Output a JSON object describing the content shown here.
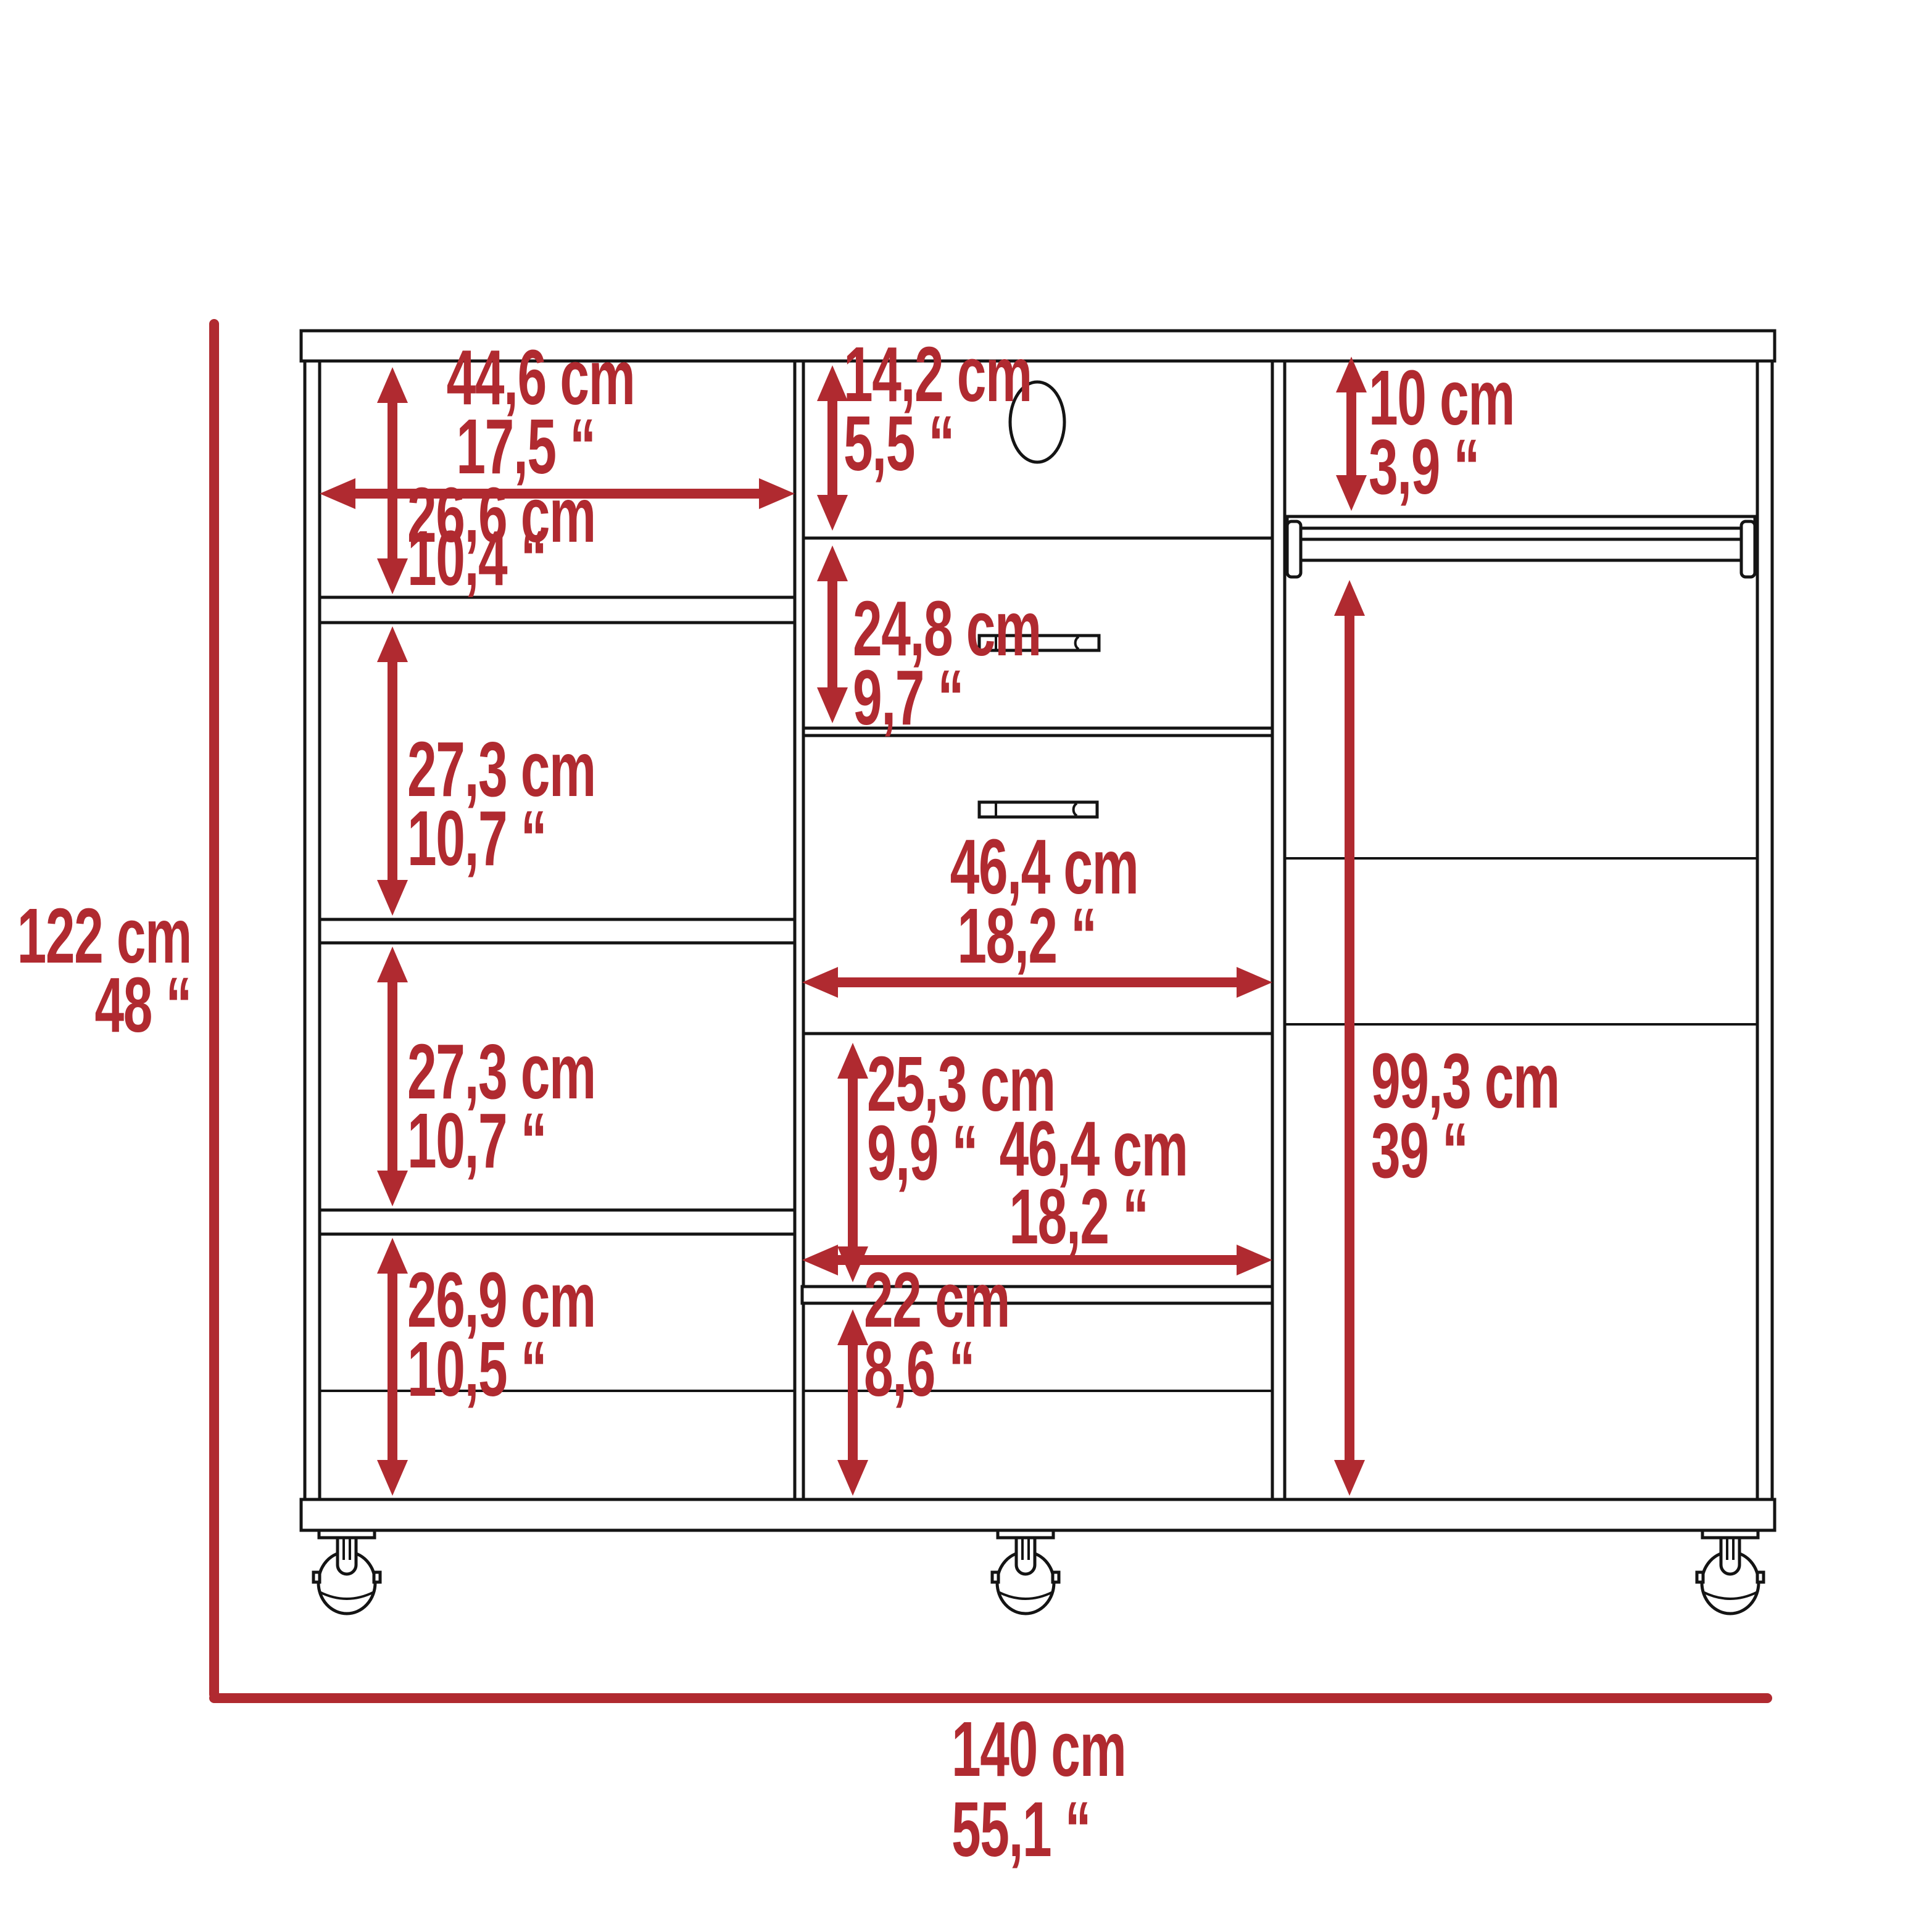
{
  "diagram": {
    "kind": "furniture-technical-drawing",
    "subject": "three-section dresser closet with drawers, shelves, hanging rod and casters",
    "colors": {
      "annotation": "#b02a30",
      "line": "#141414",
      "background": "#ffffff"
    }
  },
  "dimensions": {
    "overall_height": {
      "cm": "122 cm",
      "in": "48 “"
    },
    "overall_width": {
      "cm": "140 cm",
      "in": "55,1 “"
    },
    "left_column_width": {
      "cm": "44,6 cm",
      "in": "17,5 “"
    },
    "left_compartment_1": {
      "cm": "26,6 cm",
      "in": "10,4 “"
    },
    "left_compartment_2": {
      "cm": "27,3 cm",
      "in": "10,7 “"
    },
    "left_compartment_3": {
      "cm": "27,3 cm",
      "in": "10,7 “"
    },
    "left_compartment_4": {
      "cm": "26,9 cm",
      "in": "10,5 “"
    },
    "middle_top_opening": {
      "cm": "14,2 cm",
      "in": "5,5 “"
    },
    "drawer_front_height": {
      "cm": "24,8 cm",
      "in": "9,7 “"
    },
    "drawer_width": {
      "cm": "46,4 cm",
      "in": "18,2 “"
    },
    "middle_opening_height": {
      "cm": "25,3 cm",
      "in": "9,9 “"
    },
    "middle_opening_width": {
      "cm": "46,4 cm",
      "in": "18,2 “"
    },
    "middle_bottom_height": {
      "cm": "22 cm",
      "in": "8,6 “"
    },
    "rod_clearance": {
      "cm": "10 cm",
      "in": "3,9 “"
    },
    "hanging_section_height": {
      "cm": "99,3 cm",
      "in": "39 “"
    }
  }
}
